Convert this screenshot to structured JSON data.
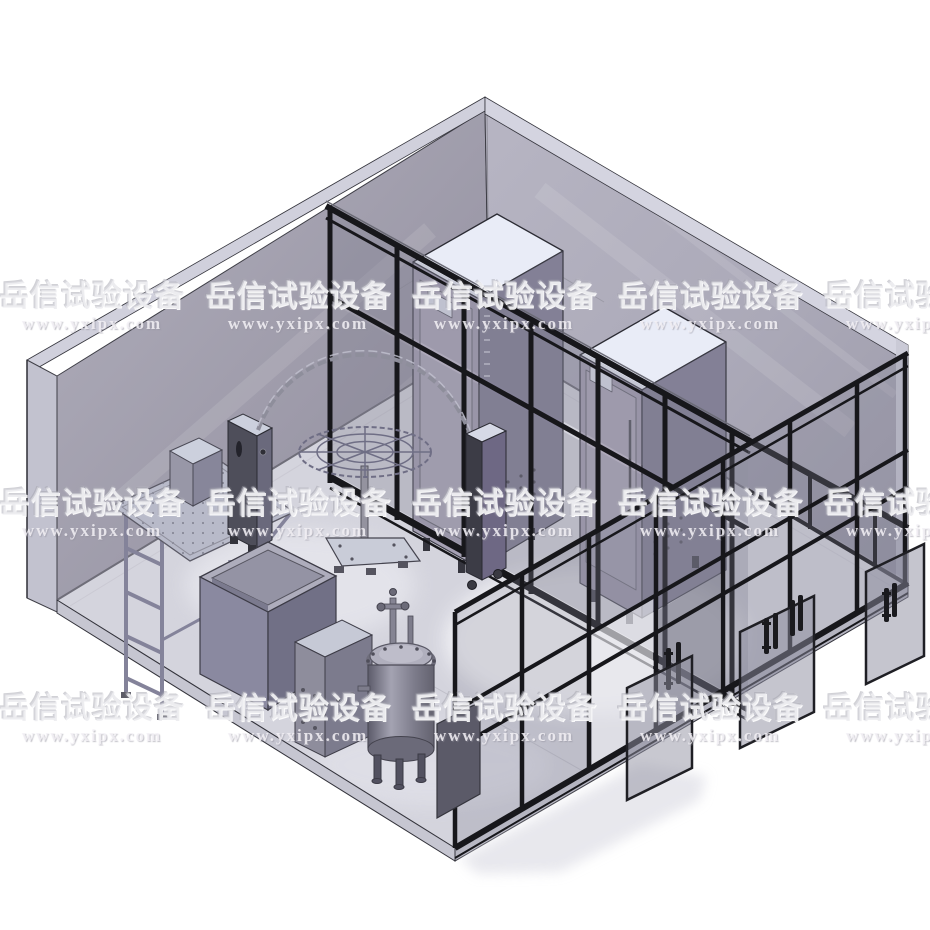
{
  "image_type": "3d-cad-isometric-render",
  "subject": "glass-partitioned environmental test laboratory enclosure with spray test equipment",
  "watermark": {
    "line1": "岳信试验设备",
    "line2": "www.yxipx.com",
    "grid": {
      "col_centers": [
        92,
        298,
        504,
        710,
        916
      ],
      "row_tops": [
        282,
        489,
        694
      ]
    }
  },
  "palette": {
    "background": "#ffffff",
    "frame_black": "#17171b",
    "glass_tint": "rgba(128,128,145,0.30)",
    "wall_left": "#9d9aa9",
    "wall_right": "#aba9b8",
    "wall_top_band": "#d2d2de",
    "floor": "#d4d4dd",
    "chamber_top_white": "#e9ecf7",
    "chamber_front_purple": "#a5a0b3",
    "chamber_side_purple": "#838096",
    "equipment_dark": "#4e4e5a",
    "metal_light": "#c9ccd8",
    "watermark_text": "rgba(224,224,230,0.55)"
  },
  "equipment": [
    {
      "name": "drip-test-table"
    },
    {
      "name": "spray-control-pillar"
    },
    {
      "name": "oscillating-spray-arc"
    },
    {
      "name": "rotating-spray-turntable"
    },
    {
      "name": "specimen-panel-cart"
    },
    {
      "name": "test-chamber-1"
    },
    {
      "name": "test-chamber-2"
    },
    {
      "name": "open-test-bin"
    },
    {
      "name": "control-box"
    },
    {
      "name": "pressure-tank"
    },
    {
      "name": "dark-door-panel"
    },
    {
      "name": "sliding-glass-doors"
    }
  ]
}
